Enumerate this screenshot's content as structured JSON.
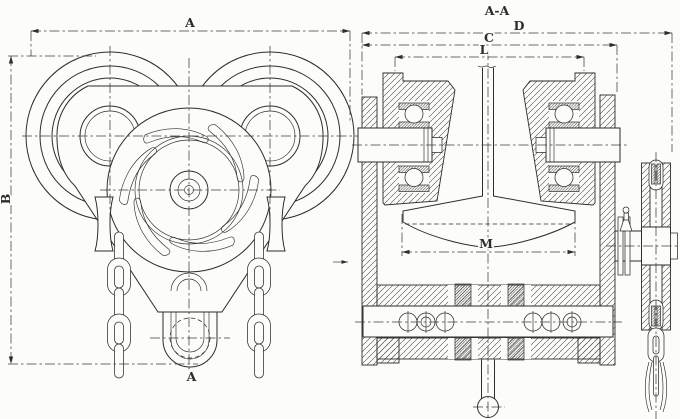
{
  "palette": {
    "bg": "#fcfcfa",
    "ink": "#2d2d2d",
    "dim": "#3c3c3c"
  },
  "front_view": {
    "dim_width_label": "A",
    "dim_height_label": "B",
    "section_cut_label": "A"
  },
  "section_view": {
    "title": "A-A",
    "dim_overall_width_label": "D",
    "dim_plate_span_label": "C",
    "dim_wheel_span_label": "L",
    "dim_flange_width_label": "M"
  }
}
